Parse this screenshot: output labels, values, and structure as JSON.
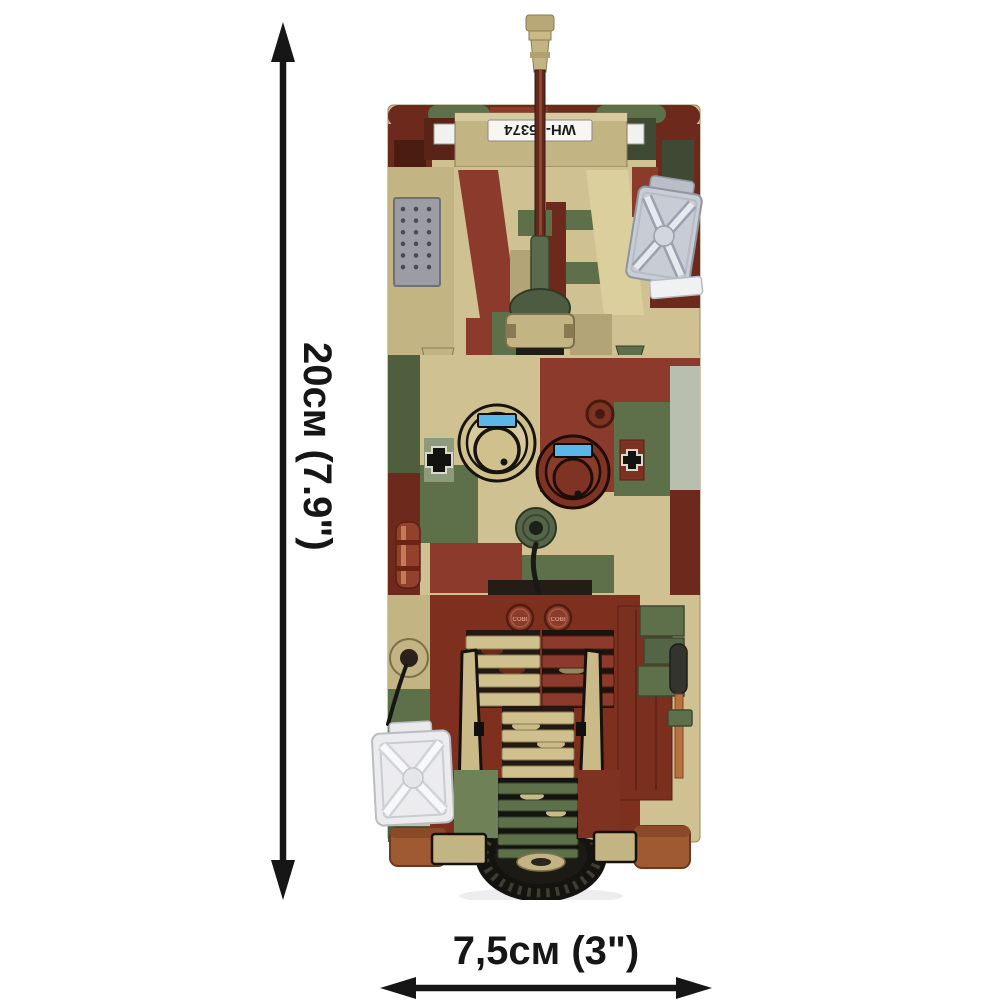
{
  "page": {
    "background": "#ffffff"
  },
  "product": {
    "license_plate": "WH-55374",
    "stud_logo": "COBI"
  },
  "dimensions": {
    "height_label": "20см (7.9\")",
    "width_label": "7,5см (3\")"
  },
  "colors": {
    "background": "#ffffff",
    "arrow": "#161616",
    "label_text": "#161616",
    "camo_red": "#8c3a2b",
    "camo_red_dark": "#6d2a1c",
    "camo_green": "#5d7049",
    "camo_green_dark": "#4f5f3e",
    "camo_tan": "#cfc192",
    "camo_tan_dark": "#b3a478",
    "camo_tan_light": "#dccf9e",
    "camo_sage": "#b9bfae",
    "track_brown": "#a05a32",
    "barrel_brown": "#5f2a1b",
    "grille_gray": "#9b9ca4",
    "jerrycan_gray": "#c8ccd5",
    "jerrycan_white": "#ececee",
    "hatch_blue": "#5ab7e8",
    "tire_black": "#15130f"
  }
}
